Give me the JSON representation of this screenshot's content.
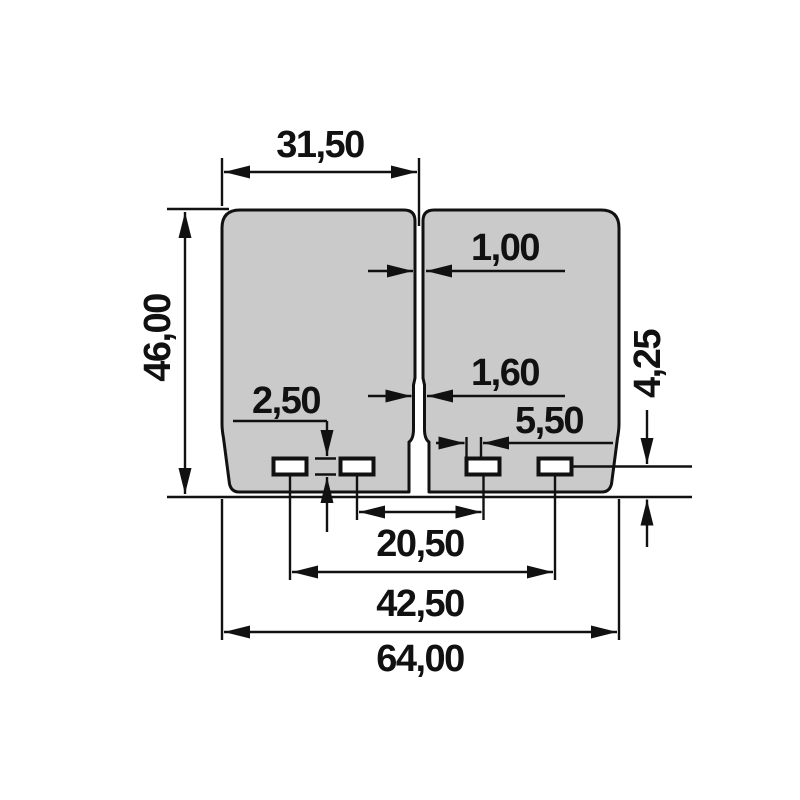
{
  "drawing": {
    "colors": {
      "background": "#ffffff",
      "petal_fill": "#cacaca",
      "line": "#111111"
    },
    "dimensions": {
      "petal_width_top": "31,50",
      "petal_height": "46,00",
      "center_slit_width": "1,00",
      "center_slit_lower_width": "1,60",
      "slot_height": "2,50",
      "slot_width": "5,50",
      "slot_edge_distance": "4,25",
      "slot_spacing_inner": "20,50",
      "slot_spacing_outer": "42,50",
      "overall_width": "64,00"
    }
  }
}
